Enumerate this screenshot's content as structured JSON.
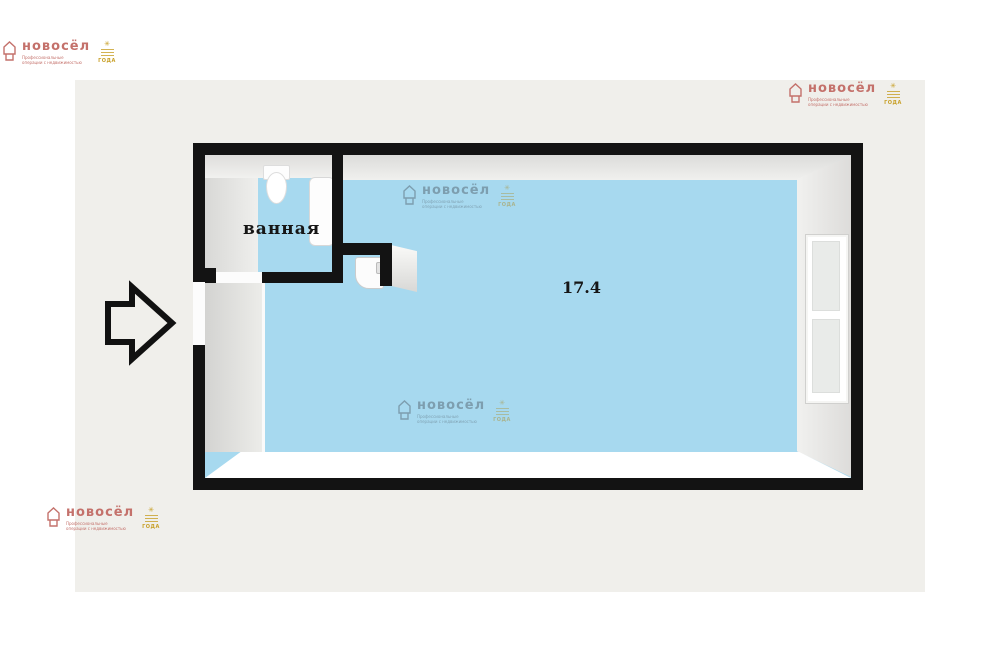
{
  "page": {
    "background_color": "#ffffff",
    "panel_color": "#f0efeb"
  },
  "floorplan": {
    "bathroom_label": "ванная",
    "room_area": "17.4",
    "colors": {
      "wall": "#131313",
      "floor": "#a7d9ef",
      "wall_3d_grey": "#d8d8d6",
      "fixture_white": "#fdfdfd"
    },
    "icons": {
      "entrance_arrow": "right-arrow outline shape",
      "toilet": "tank + oval bowl shapes",
      "bathtub": "rounded rectangle",
      "sink": "rounded square with tap",
      "window": "double pane on right wall"
    }
  },
  "watermark": {
    "brand": "новосёл",
    "tagline": "Профессиональные операции с недвижимостью",
    "badge_label": "ГОДА",
    "badge_star": "✳",
    "brand_color": "#c4716b",
    "badge_color": "#c8a028"
  }
}
